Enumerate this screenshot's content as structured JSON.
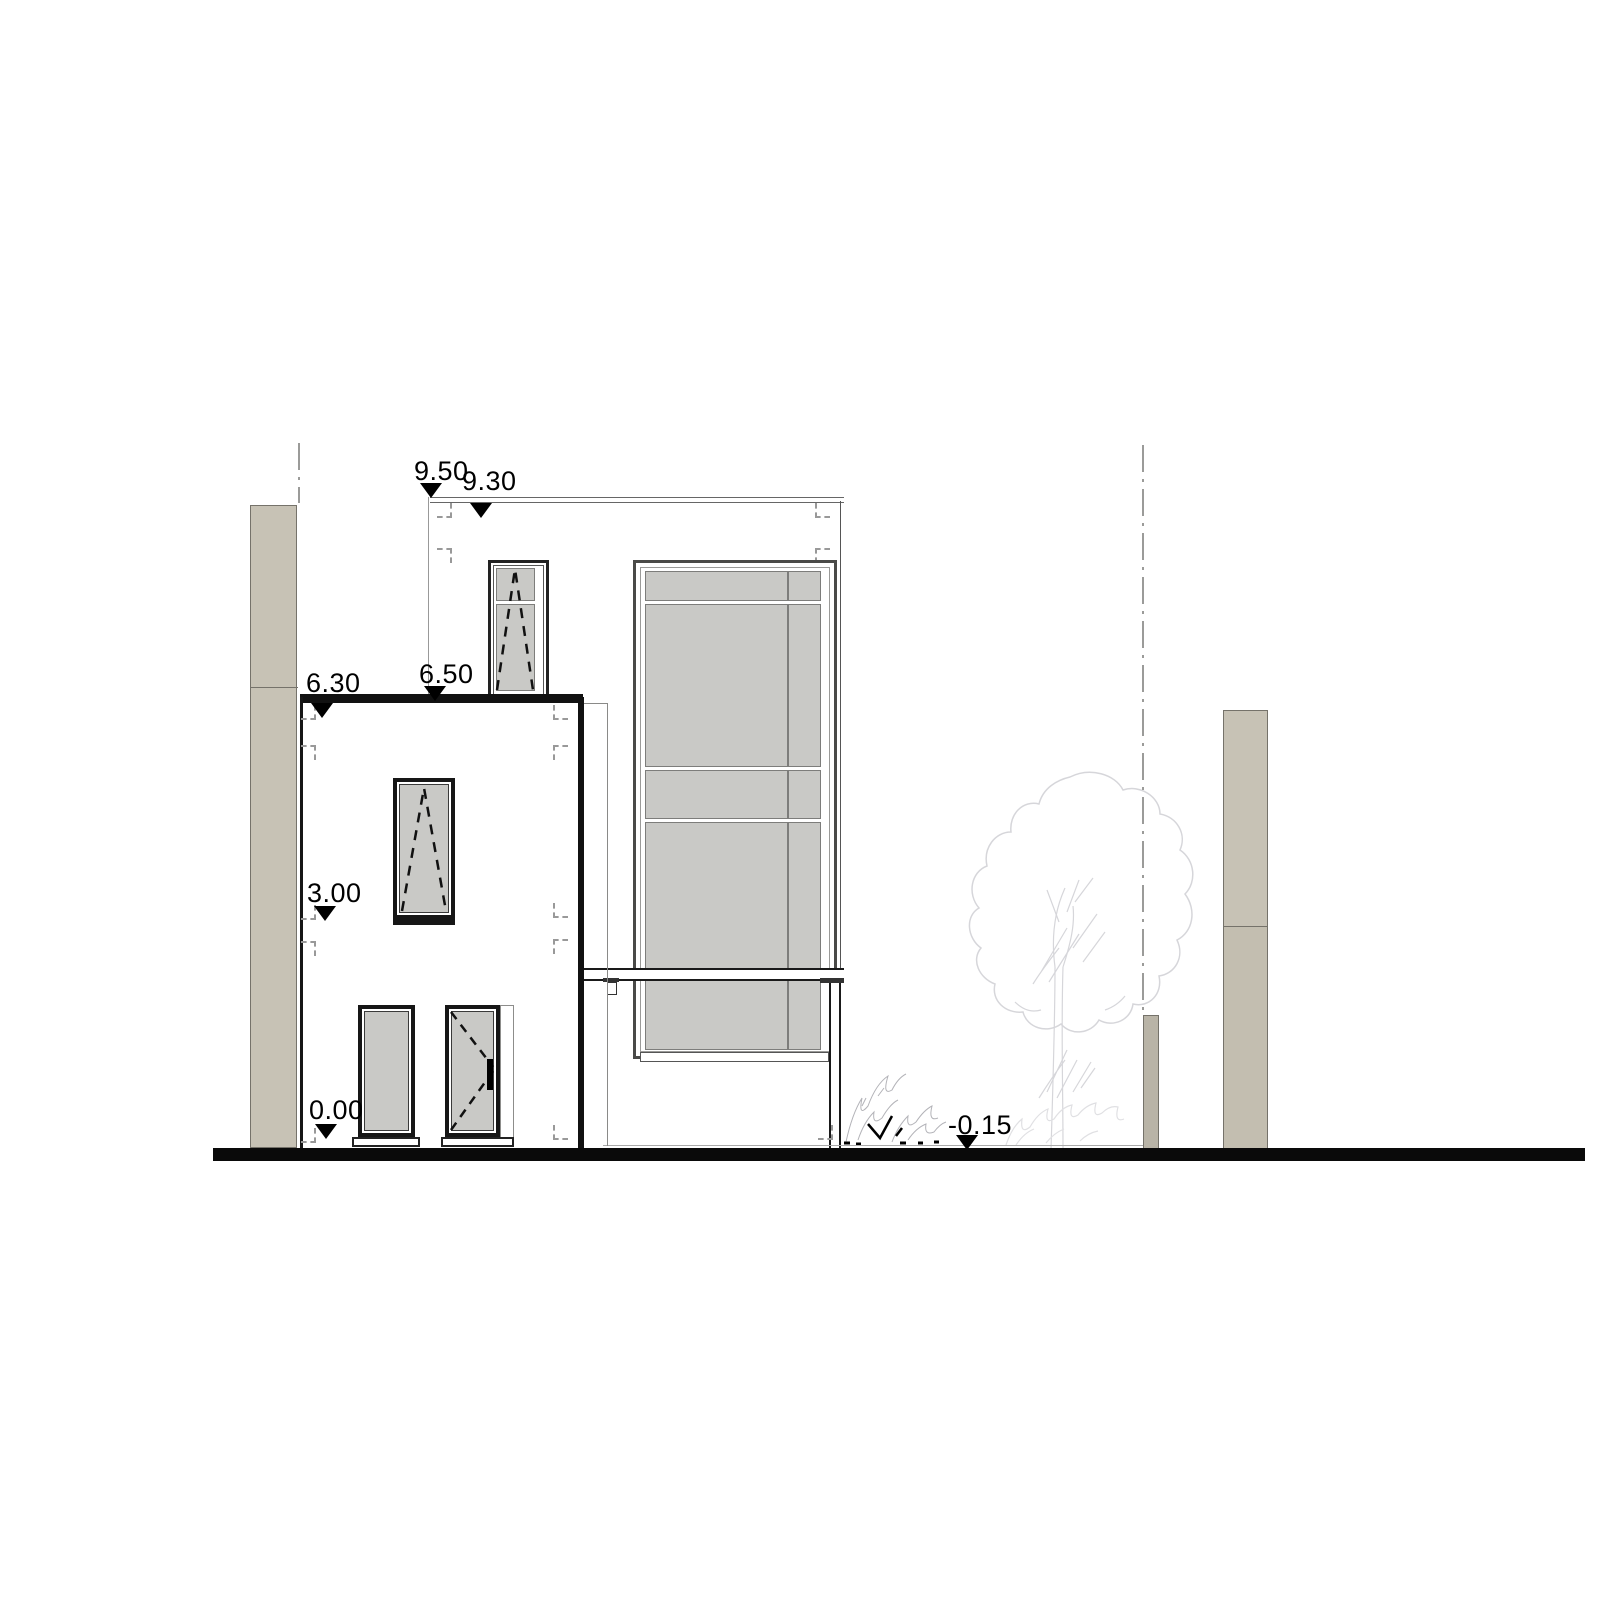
{
  "drawing": {
    "type": "architectural-elevation",
    "levels": [
      {
        "name": "roof-parapet-upper",
        "label": "9.50"
      },
      {
        "name": "roof-slab",
        "label": "9.30"
      },
      {
        "name": "lower-parapet-upper",
        "label": "6.50"
      },
      {
        "name": "lower-roof-slab",
        "label": "6.30"
      },
      {
        "name": "upper-floor",
        "label": "3.00"
      },
      {
        "name": "ground-floor",
        "label": "0.00"
      },
      {
        "name": "terrain",
        "label": "-0.15"
      }
    ],
    "colors": {
      "glass": "#c9c9c6",
      "pillar-light": "#c7c2b5",
      "pillar-mid": "#c3beb0",
      "pillar-dark": "#b9b4a7",
      "outline": "#1a1a1a",
      "frame-gray": "#555555",
      "ground": "#0a0a0a",
      "boundary": "#9b9b99",
      "mark": "#999999",
      "tree": "#d6d6da",
      "tree-faint": "#e0e0e3",
      "shrub": "#b3b3b8"
    }
  }
}
